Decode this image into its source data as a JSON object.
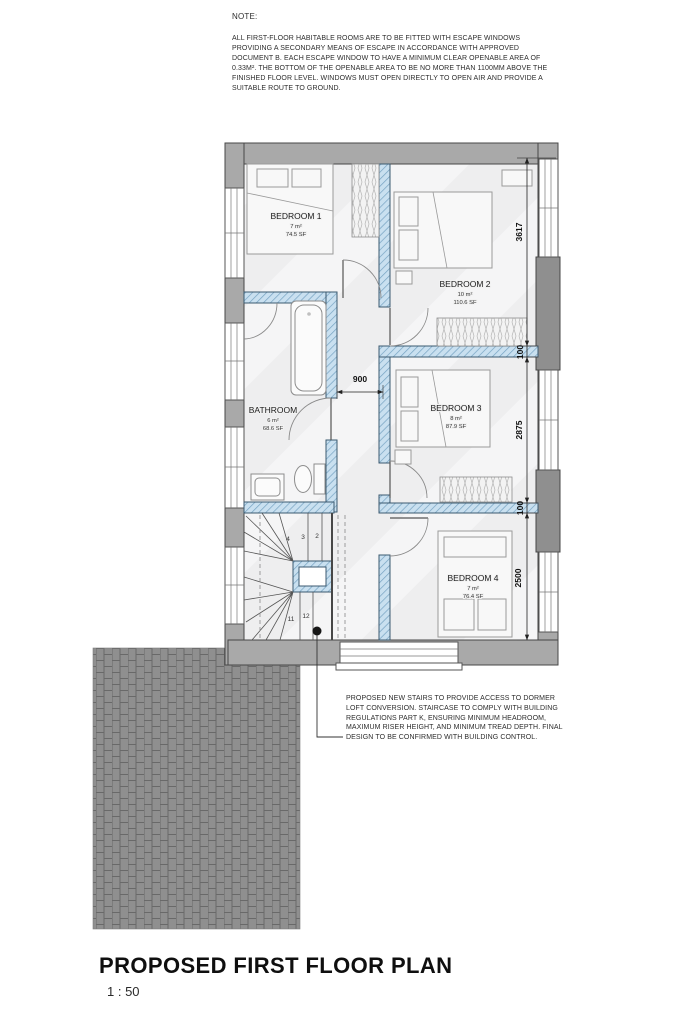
{
  "note": {
    "heading": "NOTE:",
    "body": "ALL FIRST-FLOOR HABITABLE ROOMS ARE TO BE FITTED WITH ESCAPE WINDOWS PROVIDING A SECONDARY MEANS OF ESCAPE IN ACCORDANCE WITH APPROVED DOCUMENT B. EACH ESCAPE WINDOW TO HAVE A MINIMUM CLEAR OPENABLE AREA OF 0.33M². THE BOTTOM OF THE OPENABLE AREA TO BE NO MORE THAN 1100MM ABOVE THE FINISHED FLOOR LEVEL. WINDOWS MUST OPEN DIRECTLY TO OPEN AIR AND PROVIDE A SUITABLE ROUTE TO GROUND."
  },
  "plan": {
    "rooms": [
      {
        "id": "bedroom-1",
        "name": "BEDROOM 1",
        "area_m2": "7 m²",
        "area_sf": "74.5 SF"
      },
      {
        "id": "bedroom-2",
        "name": "BEDROOM 2",
        "area_m2": "10 m²",
        "area_sf": "110.6 SF"
      },
      {
        "id": "bathroom",
        "name": "BATHROOM",
        "area_m2": "6 m²",
        "area_sf": "68.6 SF"
      },
      {
        "id": "bedroom-3",
        "name": "BEDROOM 3",
        "area_m2": "8 m²",
        "area_sf": "87.9 SF"
      },
      {
        "id": "bedroom-4",
        "name": "BEDROOM 4",
        "area_m2": "7 m²",
        "area_sf": "76.4 SF"
      }
    ],
    "dimensions": {
      "right_chain": [
        "3617",
        "100",
        "2875",
        "100",
        "2500"
      ],
      "corridor_width": "900"
    },
    "stair_treads": [
      "2",
      "3",
      "4",
      "11",
      "12"
    ]
  },
  "annotation": {
    "stairs_note": "PROPOSED NEW STAIRS TO PROVIDE ACCESS TO DORMER LOFT CONVERSION. STAIRCASE TO COMPLY WITH BUILDING REGULATIONS PART K, ENSURING MINIMUM HEADROOM, MAXIMUM RISER HEIGHT, AND MINIMUM TREAD DEPTH. FINAL DESIGN TO BE CONFIRMED WITH BUILDING CONTROL."
  },
  "title_block": {
    "title": "PROPOSED FIRST FLOOR PLAN",
    "scale": "1 : 50"
  },
  "colors": {
    "new_wall": "#c9e0f0",
    "existing_wall": "#a9a9a9",
    "paving": "#8f8f8f"
  }
}
